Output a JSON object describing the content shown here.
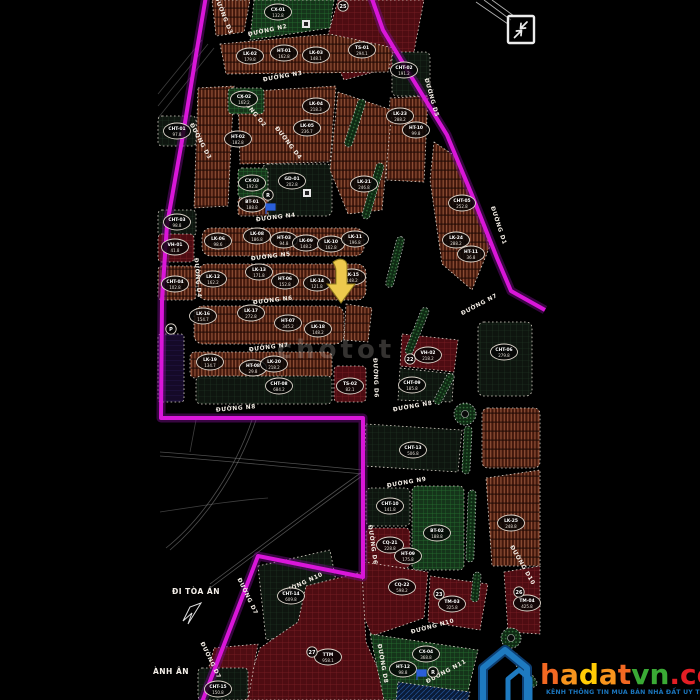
{
  "title": "Bản đồ quy hoạch phân lô",
  "colors": {
    "boundary_magenta": "#d916d9",
    "boundary_glow": "#7a0d8f",
    "highlight_arrow": "#edc94d",
    "marker_blue": "#2a5fd9",
    "logo_house_blue": "#1e7ac0",
    "logo_house_shadow": "#0d3f73",
    "logo_dot_red": "#e31e24",
    "logo_green": "#3aaa35"
  },
  "map": {
    "photo_watermark": "chotot",
    "street_labels": [
      {
        "t": "ĐƯỜNG N2",
        "x": 268,
        "y": 32,
        "r": -12
      },
      {
        "t": "ĐƯỜNG N3",
        "x": 283,
        "y": 78,
        "r": -10
      },
      {
        "t": "ĐƯỜNG N4",
        "x": 276,
        "y": 219,
        "r": -7
      },
      {
        "t": "ĐƯỜNG N5",
        "x": 271,
        "y": 258,
        "r": -7
      },
      {
        "t": "ĐƯỜNG N6",
        "x": 273,
        "y": 302,
        "r": -7
      },
      {
        "t": "ĐƯỜNG N7",
        "x": 269,
        "y": 349,
        "r": -7
      },
      {
        "t": "ĐƯỜNG N7",
        "x": 480,
        "y": 306,
        "r": -28
      },
      {
        "t": "ĐƯỜNG N8",
        "x": 236,
        "y": 410,
        "r": -5
      },
      {
        "t": "ĐƯỜNG N8",
        "x": 413,
        "y": 408,
        "r": -10
      },
      {
        "t": "ĐƯỜNG N9",
        "x": 407,
        "y": 484,
        "r": -10
      },
      {
        "t": "ĐƯỜNG N10",
        "x": 303,
        "y": 585,
        "r": -25
      },
      {
        "t": "ĐƯỜNG N10",
        "x": 433,
        "y": 628,
        "r": -15
      },
      {
        "t": "ĐƯỜNG N11",
        "x": 447,
        "y": 673,
        "r": -28
      },
      {
        "t": "ĐƯỜNG D3",
        "x": 222,
        "y": 16,
        "r": 68
      },
      {
        "t": "ĐƯỜNG D2",
        "x": 251,
        "y": 112,
        "r": 50
      },
      {
        "t": "ĐƯỜNG D4",
        "x": 287,
        "y": 144,
        "r": 52
      },
      {
        "t": "ĐƯỜNG D3",
        "x": 199,
        "y": 142,
        "r": 62
      },
      {
        "t": "ĐƯỜNG D4",
        "x": 196,
        "y": 278,
        "r": 85
      },
      {
        "t": "ĐƯỜNG D5",
        "x": 430,
        "y": 98,
        "r": 74
      },
      {
        "t": "ĐƯỜNG D1",
        "x": 497,
        "y": 226,
        "r": 72
      },
      {
        "t": "ĐƯỜNG D6",
        "x": 374,
        "y": 378,
        "r": 88
      },
      {
        "t": "ĐƯỜNG D6",
        "x": 371,
        "y": 545,
        "r": 82
      },
      {
        "t": "ĐƯỜNG D7",
        "x": 246,
        "y": 597,
        "r": 64
      },
      {
        "t": "ĐƯỜNG D7",
        "x": 209,
        "y": 661,
        "r": 64
      },
      {
        "t": "ĐƯỜNG D8",
        "x": 381,
        "y": 664,
        "r": 80
      },
      {
        "t": "ĐƯỜNG D10",
        "x": 521,
        "y": 566,
        "r": 60
      }
    ],
    "plots": [
      {
        "c": "CX-01",
        "a": "132.8",
        "x": 278,
        "y": 12
      },
      {
        "c": "TS-01",
        "a": "294.1",
        "x": 362,
        "y": 50
      },
      {
        "c": "LK-02",
        "a": "179.8",
        "x": 250,
        "y": 56
      },
      {
        "c": "HT-01",
        "a": "162.8",
        "x": 284,
        "y": 53
      },
      {
        "c": "LK-03",
        "a": "148.1",
        "x": 316,
        "y": 55
      },
      {
        "c": "CX-02",
        "a": "162.2",
        "x": 244,
        "y": 99
      },
      {
        "c": "LK-04",
        "a": "218.3",
        "x": 316,
        "y": 106
      },
      {
        "c": "LK-05",
        "a": "236.7",
        "x": 307,
        "y": 128
      },
      {
        "c": "HT-02",
        "a": "182.8",
        "x": 238,
        "y": 139
      },
      {
        "c": "CHT-01",
        "a": "97.8",
        "x": 177,
        "y": 131
      },
      {
        "c": "CHT-02",
        "a": "191.2",
        "x": 404,
        "y": 70
      },
      {
        "c": "LK-23",
        "a": "288.2",
        "x": 400,
        "y": 116
      },
      {
        "c": "HT-10",
        "a": "99.8",
        "x": 416,
        "y": 130
      },
      {
        "c": "LK-21",
        "a": "246.8",
        "x": 364,
        "y": 184
      },
      {
        "c": "CHT-05",
        "a": "252.8",
        "x": 462,
        "y": 203
      },
      {
        "c": "LK-24",
        "a": "288.2",
        "x": 456,
        "y": 240
      },
      {
        "c": "HT-11",
        "a": "36.8",
        "x": 471,
        "y": 254
      },
      {
        "c": "GD-01",
        "a": "202.8",
        "x": 292,
        "y": 181
      },
      {
        "c": "CX-03",
        "a": "192.8",
        "x": 252,
        "y": 183
      },
      {
        "c": "BT-01",
        "a": "188.8",
        "x": 252,
        "y": 204
      },
      {
        "c": "VH-01",
        "a": "41.8",
        "x": 175,
        "y": 247
      },
      {
        "c": "CHT-03",
        "a": "98.8",
        "x": 177,
        "y": 222
      },
      {
        "c": "CHT-04",
        "a": "102.8",
        "x": 175,
        "y": 284
      },
      {
        "c": "LK-06",
        "a": "98.6",
        "x": 218,
        "y": 241
      },
      {
        "c": "LK-08",
        "a": "186.8",
        "x": 257,
        "y": 236
      },
      {
        "c": "HT-03",
        "a": "94.8",
        "x": 284,
        "y": 240
      },
      {
        "c": "LK-09",
        "a": "148.2",
        "x": 306,
        "y": 243
      },
      {
        "c": "LK-10",
        "a": "162.8",
        "x": 331,
        "y": 244
      },
      {
        "c": "LK-11",
        "a": "196.8",
        "x": 355,
        "y": 239
      },
      {
        "c": "LK-12",
        "a": "162.2",
        "x": 213,
        "y": 279
      },
      {
        "c": "LK-13",
        "a": "171.8",
        "x": 259,
        "y": 272
      },
      {
        "c": "HT-06",
        "a": "152.8",
        "x": 285,
        "y": 281
      },
      {
        "c": "LK-14",
        "a": "121.8",
        "x": 317,
        "y": 283
      },
      {
        "c": "LK-15",
        "a": "148.2",
        "x": 352,
        "y": 277
      },
      {
        "c": "LK-16",
        "a": "154.7",
        "x": 203,
        "y": 316
      },
      {
        "c": "LK-17",
        "a": "272.8",
        "x": 251,
        "y": 313
      },
      {
        "c": "HT-07",
        "a": "345.2",
        "x": 288,
        "y": 323
      },
      {
        "c": "LK-18",
        "a": "148.2",
        "x": 318,
        "y": 329
      },
      {
        "c": "LK-19",
        "a": "134.7",
        "x": 210,
        "y": 362
      },
      {
        "c": "HT-08",
        "a": "29.8",
        "x": 253,
        "y": 368
      },
      {
        "c": "LK-20",
        "a": "218.2",
        "x": 274,
        "y": 364
      },
      {
        "c": "CHT-08",
        "a": "684.2",
        "x": 279,
        "y": 386
      },
      {
        "c": "TS-02",
        "a": "82.1",
        "x": 350,
        "y": 386
      },
      {
        "c": "VH-02",
        "a": "218.2",
        "x": 428,
        "y": 355
      },
      {
        "c": "CHT-09",
        "a": "185.8",
        "x": 412,
        "y": 385
      },
      {
        "c": "CHT-06",
        "a": "279.8",
        "x": 504,
        "y": 352
      },
      {
        "c": "CHT-13",
        "a": "506.8",
        "x": 413,
        "y": 450
      },
      {
        "c": "CHT-10",
        "a": "141.8",
        "x": 390,
        "y": 506
      },
      {
        "c": "CQ-21",
        "a": "228.8",
        "x": 390,
        "y": 545
      },
      {
        "c": "HT-09",
        "a": "175.8",
        "x": 408,
        "y": 556
      },
      {
        "c": "BT-02",
        "a": "188.8",
        "x": 437,
        "y": 533
      },
      {
        "c": "LK-25",
        "a": "248.8",
        "x": 511,
        "y": 523
      },
      {
        "c": "CQ-22",
        "a": "598.2",
        "x": 402,
        "y": 587
      },
      {
        "c": "TM-03",
        "a": "325.8",
        "x": 452,
        "y": 604
      },
      {
        "c": "TM-04",
        "a": "425.8",
        "x": 527,
        "y": 603
      },
      {
        "c": "CHT-14",
        "a": "609.8",
        "x": 291,
        "y": 596
      },
      {
        "c": "TTM",
        "a": "958.1",
        "x": 328,
        "y": 657
      },
      {
        "c": "CHT-15",
        "a": "150.8",
        "x": 218,
        "y": 689
      },
      {
        "c": "CX-04",
        "a": "368.8",
        "x": 426,
        "y": 654
      },
      {
        "c": "HT-12",
        "a": "98.8",
        "x": 403,
        "y": 669
      }
    ],
    "badges": [
      {
        "t": "25",
        "x": 343,
        "y": 6
      },
      {
        "t": "22",
        "x": 410,
        "y": 359
      },
      {
        "t": "23",
        "x": 439,
        "y": 594
      },
      {
        "t": "26",
        "x": 519,
        "y": 592
      },
      {
        "t": "27",
        "x": 312,
        "y": 652
      },
      {
        "t": "P",
        "x": 171,
        "y": 329
      },
      {
        "t": "R",
        "x": 268,
        "y": 195
      },
      {
        "t": "R",
        "x": 433,
        "y": 672
      }
    ],
    "notes": {
      "court_direction": "ĐI TÒA ÁN",
      "edge_label": "ÀNH ÂN"
    }
  },
  "logo": {
    "brand_letters": [
      {
        "ch": "h",
        "color": "#f26822"
      },
      {
        "ch": "a",
        "color": "#f7941d"
      },
      {
        "ch": "d",
        "color": "#ffcb05"
      },
      {
        "ch": "a",
        "color": "#f7941d"
      },
      {
        "ch": "t",
        "color": "#f26822"
      },
      {
        "ch": "v",
        "color": "#3aaa35"
      },
      {
        "ch": "n",
        "color": "#3aaa35"
      },
      {
        "ch": ".com.vn",
        "color": "#e31e24"
      }
    ],
    "tagline": "KÊNH THÔNG TIN MUA BÁN NHÀ ĐẤT UY TÍN"
  }
}
